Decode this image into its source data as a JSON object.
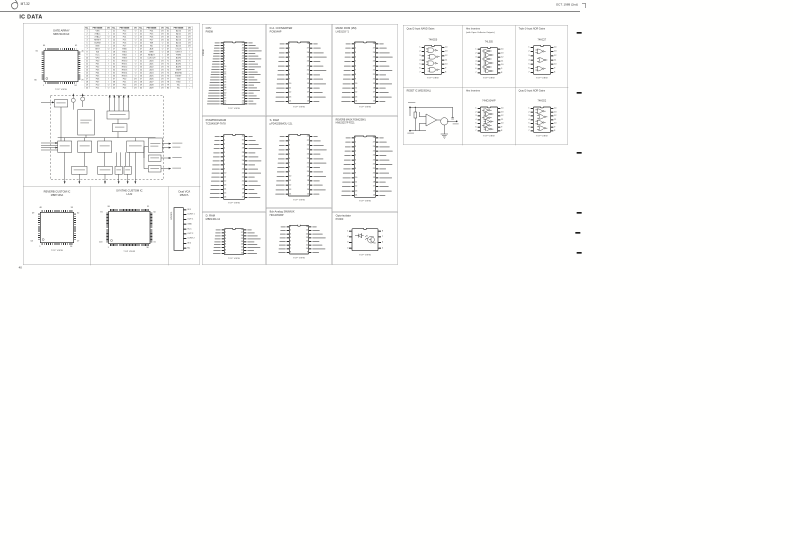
{
  "page": {
    "header_left": "MT-32",
    "header_right": "OCT. 1989 (2nd)",
    "title": "IC DATA",
    "page_number": "40"
  },
  "gate_array": {
    "title": "GATE ARRAY",
    "part": "MB674163/GF",
    "package": {
      "kind": "qfp",
      "caption": "TOP VIEW",
      "corners": {
        "tl": "64",
        "tr": "41",
        "rt": "40",
        "rb": "25",
        "br": "24",
        "bl": "1",
        "lb": "80",
        "lt": "65"
      }
    }
  },
  "pin_table": {
    "headers": [
      "No.",
      "PIN NAME",
      "I/O"
    ],
    "pins": [
      [
        1,
        "VSS",
        "-"
      ],
      [
        2,
        "XTAL1",
        "I"
      ],
      [
        3,
        "XTAL2",
        "O"
      ],
      [
        4,
        "RESET",
        "I"
      ],
      [
        5,
        "BUSW",
        "I"
      ],
      [
        6,
        "NMI",
        "I"
      ],
      [
        7,
        "INST",
        "O"
      ],
      [
        8,
        "EA",
        "I"
      ],
      [
        9,
        "VCC",
        "-"
      ],
      [
        10,
        "VPD",
        "-"
      ],
      [
        11,
        "P00",
        "I"
      ],
      [
        12,
        "P01",
        "I"
      ],
      [
        13,
        "P02",
        "I"
      ],
      [
        14,
        "P03",
        "I"
      ],
      [
        15,
        "P04",
        "I"
      ],
      [
        16,
        "P05",
        "I"
      ],
      [
        17,
        "P06",
        "I"
      ],
      [
        18,
        "P07",
        "I"
      ],
      [
        19,
        "P10",
        "O"
      ],
      [
        20,
        "P11",
        "O"
      ],
      [
        21,
        "P12",
        "O"
      ],
      [
        22,
        "P13",
        "O"
      ],
      [
        23,
        "P14",
        "O"
      ],
      [
        24,
        "P15",
        "O"
      ],
      [
        25,
        "P16",
        "O"
      ],
      [
        26,
        "P17",
        "O"
      ],
      [
        27,
        "HSI0",
        "I"
      ],
      [
        28,
        "HSI1",
        "I"
      ],
      [
        29,
        "HSI2",
        "I"
      ],
      [
        30,
        "HSI3",
        "I"
      ],
      [
        31,
        "HSO0",
        "O"
      ],
      [
        32,
        "HSO1",
        "O"
      ],
      [
        33,
        "HSO2",
        "O"
      ],
      [
        34,
        "HSO3",
        "O"
      ],
      [
        35,
        "HSO4",
        "O"
      ],
      [
        36,
        "HSO5",
        "O"
      ],
      [
        37,
        "P20",
        "I/O"
      ],
      [
        38,
        "P21",
        "I/O"
      ],
      [
        39,
        "P22",
        "I/O"
      ],
      [
        40,
        "P23",
        "I/O"
      ],
      [
        41,
        "P24",
        "I/O"
      ],
      [
        42,
        "P25",
        "I/O"
      ],
      [
        43,
        "P26",
        "I/O"
      ],
      [
        44,
        "P27",
        "I/O"
      ],
      [
        45,
        "WR",
        "O"
      ],
      [
        46,
        "RD",
        "O"
      ],
      [
        47,
        "ALE",
        "O"
      ],
      [
        48,
        "BHE",
        "O"
      ],
      [
        49,
        "READY",
        "I"
      ],
      [
        50,
        "CLKOUT",
        "O"
      ],
      [
        51,
        "AD0",
        "I/O"
      ],
      [
        52,
        "AD1",
        "I/O"
      ],
      [
        53,
        "AD2",
        "I/O"
      ],
      [
        54,
        "AD3",
        "I/O"
      ],
      [
        55,
        "AD4",
        "I/O"
      ],
      [
        56,
        "AD5",
        "I/O"
      ],
      [
        57,
        "AD6",
        "I/O"
      ],
      [
        58,
        "AD7",
        "I/O"
      ],
      [
        59,
        "AD8",
        "I/O"
      ],
      [
        60,
        "AD9",
        "I/O"
      ],
      [
        61,
        "AD10",
        "I/O"
      ],
      [
        62,
        "AD11",
        "I/O"
      ],
      [
        63,
        "AD12",
        "I/O"
      ],
      [
        64,
        "AD13",
        "I/O"
      ],
      [
        65,
        "AD14",
        "I/O"
      ],
      [
        66,
        "AD15",
        "I/O"
      ],
      [
        67,
        "T2CLK",
        "I"
      ],
      [
        68,
        "T2RST",
        "I"
      ],
      [
        69,
        "PWM",
        "O"
      ],
      [
        70,
        "ACH0",
        "I"
      ],
      [
        71,
        "ACH1",
        "I"
      ],
      [
        72,
        "ACH2",
        "I"
      ],
      [
        73,
        "ACH3",
        "I"
      ],
      [
        74,
        "VREF",
        "-"
      ],
      [
        75,
        "ANGND",
        "-"
      ],
      [
        76,
        "EXINT",
        "I"
      ],
      [
        77,
        "TXD",
        "O"
      ],
      [
        78,
        "RXD",
        "I"
      ],
      [
        79,
        "NC",
        "-"
      ],
      [
        80,
        "NC",
        "-"
      ]
    ]
  },
  "custom_ics": {
    "reverb": {
      "title": "REVERB CUSTOM IC",
      "part": "MB87136A",
      "package": {
        "kind": "qfp",
        "caption": "TOP VIEW",
        "corners": {
          "tl": "48",
          "tr": "33",
          "rt": "32",
          "rb": "17",
          "br": "16",
          "bl": "1",
          "lb": "64",
          "lt": "49"
        }
      }
    },
    "synth": {
      "title": "SYNTHE CUSTOM IC",
      "part": "LA32",
      "package": {
        "kind": "qfp",
        "caption": "TOP VIEW",
        "corners": {
          "tl": "80",
          "tr": "51",
          "rt": "50",
          "rb": "31",
          "br": "30",
          "bl": "1",
          "lb": "100",
          "lt": "81"
        }
      }
    },
    "vca": {
      "title": "Dual VCA",
      "part": "M5207L",
      "pins": [
        "IN 1",
        "CONT 1",
        "OUT 1",
        "GND",
        "VCC",
        "OUT 2",
        "CONT 2",
        "IN 2",
        "NC"
      ]
    }
  },
  "ic_panels": [
    {
      "id": "cpu",
      "title": "CPU",
      "part": "P8098",
      "package": {
        "kind": "dip",
        "pins": 24,
        "caption": "TOP VIEW"
      }
    },
    {
      "id": "pcm-program",
      "title": "PCM/PROGRAM",
      "part": "TC534000P-TA78",
      "package": {
        "kind": "dip",
        "pins": 16,
        "caption": "TOP VIEW"
      }
    },
    {
      "id": "dram",
      "title": "D. RAM",
      "part": "MB81464-12",
      "package": {
        "kind": "dip",
        "pins": 9,
        "caption": "TOP VIEW"
      }
    },
    {
      "id": "dac",
      "title": "D.A. CONVERTER",
      "part": "PCM54HP",
      "package": {
        "kind": "dip",
        "pins": 14,
        "caption": "TOP VIEW"
      }
    },
    {
      "id": "sram",
      "title": "S. RAM",
      "part": "µPD43256MGU-12L",
      "package": {
        "kind": "dip",
        "pins": 14,
        "caption": "TOP VIEW"
      }
    },
    {
      "id": "analog-sw",
      "title": "8ch Analog SW/MUX",
      "part": "HD14051BP",
      "package": {
        "kind": "dip",
        "pins": 8,
        "caption": "TOP VIEW"
      }
    },
    {
      "id": "mask-rom",
      "title": "MASK ROM (2M)",
      "part": "LH53103 *1",
      "package": {
        "kind": "dip",
        "pins": 14,
        "caption": "TOP VIEW"
      }
    },
    {
      "id": "reverb-rom",
      "title": "REVERB MASK ROM(256K)",
      "part": "HN623257P PZ21",
      "package": {
        "kind": "dip",
        "pins": 14,
        "caption": "TOP VIEW"
      }
    },
    {
      "id": "opto",
      "title": "Opto-isolator",
      "part": "PC900",
      "package": {
        "kind": "opto",
        "pins": 4,
        "caption": "TOP VIEW"
      }
    }
  ],
  "logic_panels": [
    {
      "id": "nand",
      "title": "Quad 2-Input NAND Gates",
      "subtitle": "",
      "part": "74HC00",
      "pins": 7,
      "gates": {
        "type": "nand",
        "count": 4
      },
      "caption": "TOP VIEW"
    },
    {
      "id": "hex-inv-oc",
      "title": "Hex Inverters",
      "subtitle": "(with Open Collector Outputs)",
      "part": "74LS05",
      "pins": 7,
      "gates": {
        "type": "inv",
        "count": 6
      },
      "caption": "TOP VIEW"
    },
    {
      "id": "nor3",
      "title": "Triple 3-Input NOR Gates",
      "subtitle": "",
      "part": "74HC27",
      "pins": 7,
      "gates": {
        "type": "nor",
        "count": 3
      },
      "caption": "TOP VIEW"
    },
    {
      "id": "reset",
      "title": "RESET IC (M51953AL)",
      "subtitle": "",
      "part": "",
      "pins": 0,
      "gates": null,
      "caption": ""
    },
    {
      "id": "hex-inv",
      "title": "Hex Inverters",
      "subtitle": "",
      "part": "74HCU04AP",
      "pins": 7,
      "gates": {
        "type": "inv",
        "count": 6
      },
      "caption": "TOP VIEW"
    },
    {
      "id": "nor2",
      "title": "Quad 2-Input NOR Gates",
      "subtitle": "",
      "part": "74HC02",
      "pins": 7,
      "gates": {
        "type": "nor",
        "count": 4
      },
      "caption": "TOP VIEW"
    }
  ]
}
